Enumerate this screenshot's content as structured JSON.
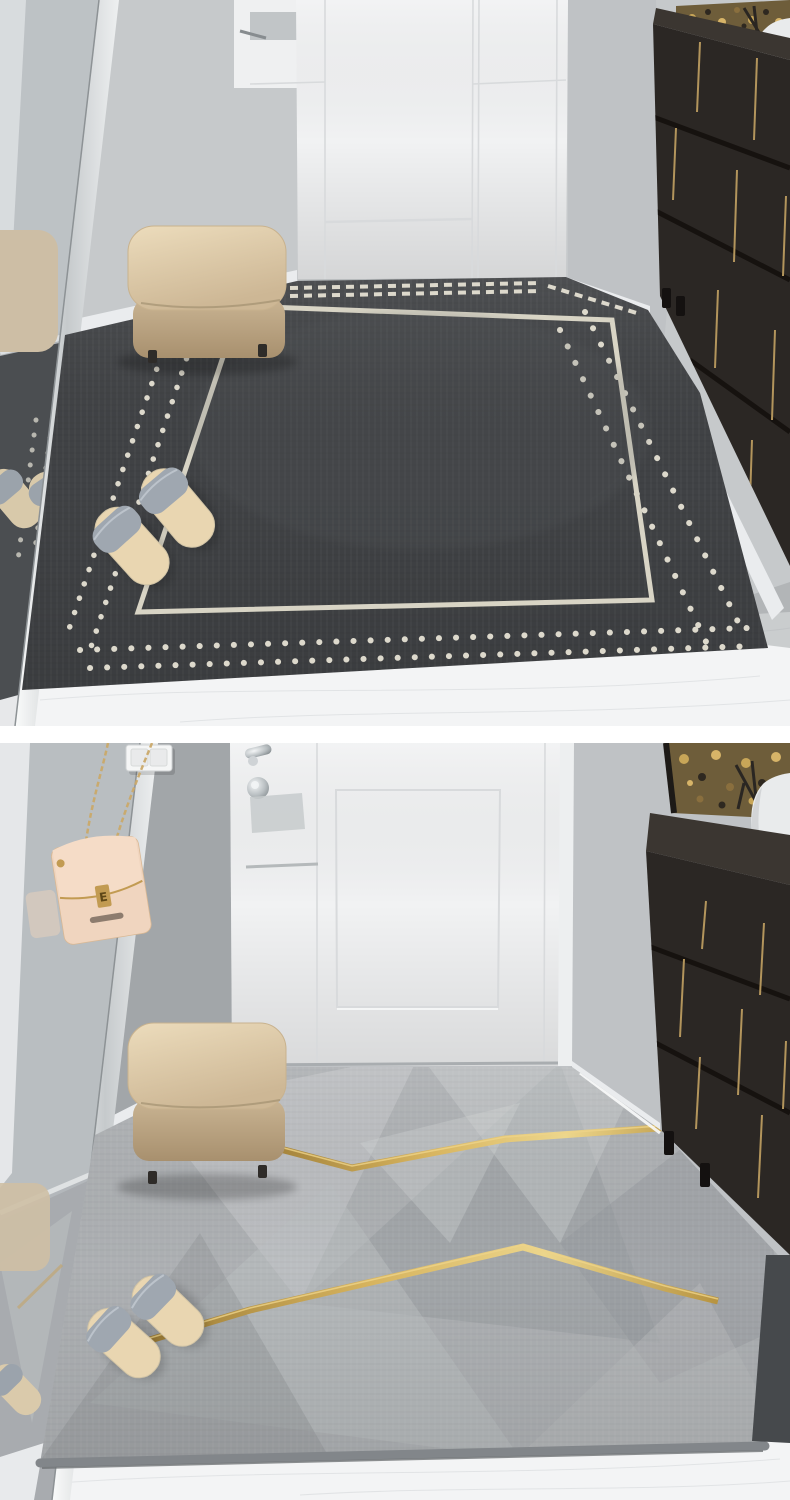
{
  "scene": {
    "type": "product-showcase",
    "panels": [
      {
        "id": "top",
        "label": "charcoal-dotted-entry-mat",
        "mat_style": "charcoal mat with double cream dot border and cream inner frame line",
        "items": [
          "wall-mirror",
          "white-entry-door",
          "white-wardrobe-corner",
          "beige-ottoman",
          "grey-slippers",
          "dark-shoe-cabinet",
          "brass-inlays",
          "gold-wall-art",
          "white-vase",
          "marble-floor"
        ]
      },
      {
        "id": "bottom",
        "label": "grey-geometric-entry-mat",
        "mat_style": "grey faceted mat with golden zigzag accent lines",
        "items": [
          "wall-mirror",
          "blush-chain-handbag",
          "light-switch",
          "white-entry-door",
          "chrome-door-lock",
          "beige-ottoman",
          "grey-slippers",
          "dark-shoe-cabinet",
          "brass-inlays",
          "gold-wall-art",
          "white-vase",
          "marble-floor"
        ]
      }
    ]
  },
  "bag": {
    "charm": "E"
  },
  "colors": {
    "wall": "#c6c9cb",
    "wall_dark": "#a2a6a9",
    "wall_right": "#bfc2c5",
    "door": "#f1f2f3",
    "door_seam": "#d8dadc",
    "marble": "#f3f4f5",
    "marble_vein": "#dde0e2",
    "mirror": "#b5b9bc",
    "mirror_rug_dark": "#3a3c3f",
    "mirror_rug_light": "#a8abae",
    "baseboard": "#eaecee",
    "mat_dark": "#404245",
    "mat_dot": "#ddd9cc",
    "mat_line": "#d8d4c5",
    "mat_light": "#adb0b3",
    "mat_binding": "#82868a",
    "gold": "#c79f47",
    "gold_hi": "#edd388",
    "cabinet": "#2b2724",
    "cabinet_top": "#3b3631",
    "cabinet_gap": "#16120f",
    "cabinet_gold": "#b3955c",
    "art_bg": "#6e5d3a",
    "art_gold": "#c8a658",
    "art_dark": "#2e2820",
    "ottoman": "#e0cdad",
    "ottoman_side": "#c3ae8d",
    "slipper": "#9fa7b0",
    "insole": "#e9d6b1",
    "vase": "#e9ebec",
    "bag": "#f0d5bf",
    "bag_gold": "#c29b52",
    "chrome": "#d9dddf",
    "lintel": "#55595c",
    "shadow_wedge": "#46494c"
  }
}
